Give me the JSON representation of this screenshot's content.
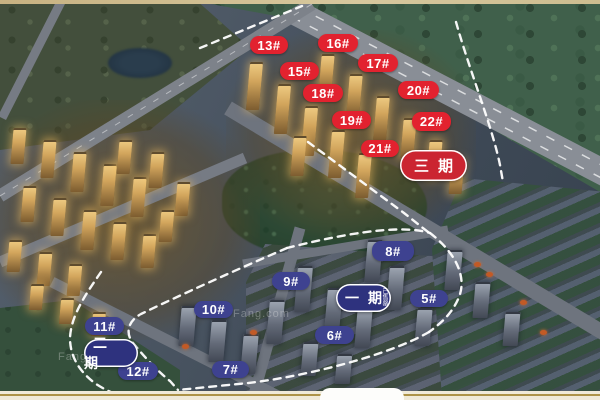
{
  "phases": [
    {
      "name": "三期",
      "type": "red",
      "x": 400,
      "y": 150,
      "w": 67,
      "h": 31,
      "sub": ""
    },
    {
      "name": "一期",
      "type": "navy",
      "x": 336,
      "y": 284,
      "w": 55,
      "h": 28,
      "sub": "已售罄"
    },
    {
      "name": "二期",
      "type": "navy",
      "x": 84,
      "y": 339,
      "w": 54,
      "h": 28,
      "sub": ""
    }
  ],
  "buildings": [
    {
      "name": "13#",
      "type": "red",
      "x": 250,
      "y": 36,
      "w": 38,
      "h": 18
    },
    {
      "name": "16#",
      "type": "red",
      "x": 318,
      "y": 34,
      "w": 40,
      "h": 18
    },
    {
      "name": "15#",
      "type": "red",
      "x": 280,
      "y": 62,
      "w": 39,
      "h": 18
    },
    {
      "name": "17#",
      "type": "red",
      "x": 358,
      "y": 54,
      "w": 40,
      "h": 18
    },
    {
      "name": "18#",
      "type": "red",
      "x": 303,
      "y": 84,
      "w": 40,
      "h": 18
    },
    {
      "name": "20#",
      "type": "red",
      "x": 398,
      "y": 81,
      "w": 41,
      "h": 18
    },
    {
      "name": "19#",
      "type": "red",
      "x": 332,
      "y": 111,
      "w": 39,
      "h": 18
    },
    {
      "name": "22#",
      "type": "red",
      "x": 412,
      "y": 112,
      "w": 39,
      "h": 19
    },
    {
      "name": "21#",
      "type": "red",
      "x": 361,
      "y": 140,
      "w": 38,
      "h": 17
    },
    {
      "name": "8#",
      "type": "navy",
      "x": 372,
      "y": 241,
      "w": 42,
      "h": 20
    },
    {
      "name": "9#",
      "type": "navy",
      "x": 272,
      "y": 272,
      "w": 38,
      "h": 18
    },
    {
      "name": "5#",
      "type": "navy",
      "x": 410,
      "y": 290,
      "w": 38,
      "h": 17
    },
    {
      "name": "10#",
      "type": "navy",
      "x": 194,
      "y": 301,
      "w": 39,
      "h": 17
    },
    {
      "name": "6#",
      "type": "navy",
      "x": 315,
      "y": 326,
      "w": 39,
      "h": 18
    },
    {
      "name": "7#",
      "type": "navy",
      "x": 212,
      "y": 361,
      "w": 37,
      "h": 17
    },
    {
      "name": "11#",
      "type": "navy",
      "x": 85,
      "y": 317,
      "w": 39,
      "h": 18
    },
    {
      "name": "12#",
      "type": "navy",
      "x": 118,
      "y": 362,
      "w": 40,
      "h": 18
    }
  ],
  "boundaries": [
    "M 200,48 L 302,6",
    "M 456,22 C 470,72 492,126 500,165 L 503,182",
    "M 308,142 L 404,213 L 428,232",
    "M 287,248 C 335,236 398,223 430,233",
    "M 430,233 C 456,253 467,277 459,297 C 452,314 441,323 429,332",
    "M 429,332 C 388,356 296,379 238,384 L 178,390",
    "M 287,248 C 238,269 176,297 141,314 C 128,321 125,333 133,343 C 142,354 156,370 170,381 L 178,390",
    "M 101,272 C 86,294 71,315 70,338 C 70,358 81,373 96,384 C 110,393 124,398 136,401"
  ],
  "colors": {
    "building_red": "#e2222f",
    "building_navy": "#3e4290",
    "phase_red": "#cb2531",
    "phase_navy": "#2e327e",
    "boundary": "#ffffff"
  },
  "watermark": {
    "text": "Fang.com"
  }
}
